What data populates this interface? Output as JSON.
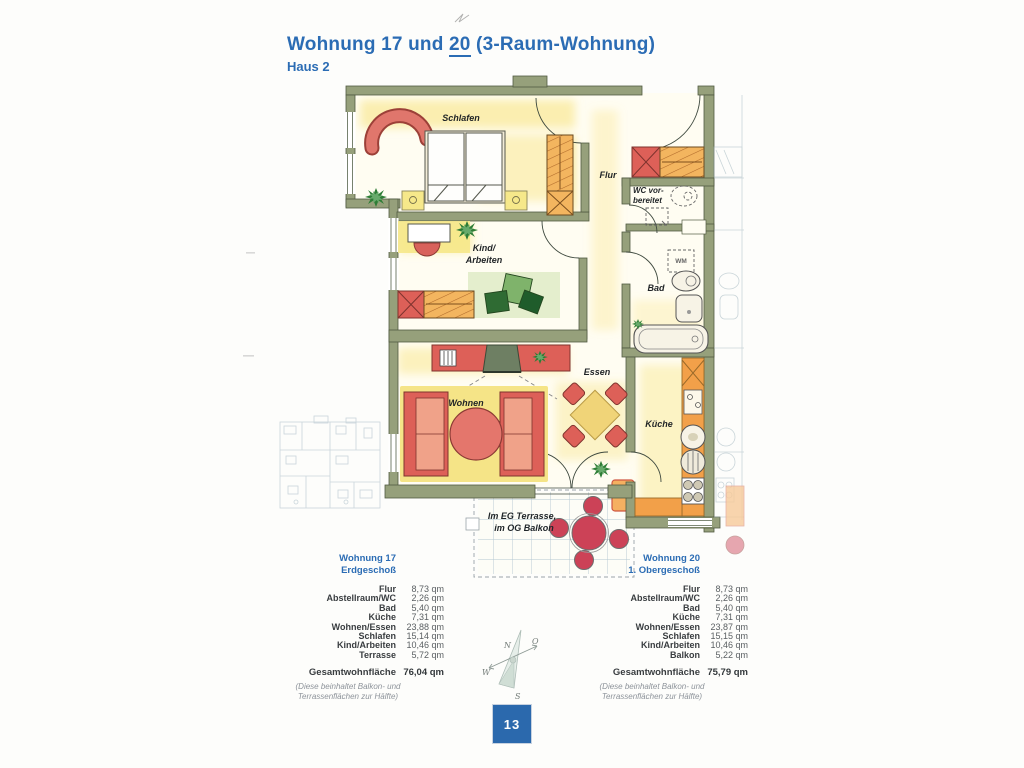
{
  "page": {
    "title_prefix": "Wohnung 17 und ",
    "title_underlined": "20",
    "title_suffix": " (3-Raum-Wohnung)",
    "subtitle": "Haus 2",
    "page_number": "13"
  },
  "colors": {
    "accent_blue": "#2b6cb4",
    "wall_olive": "#96a07b",
    "furniture_red": "#dd6058",
    "furniture_orange": "#f3b55f",
    "page_box_blue": "#2b69ad"
  },
  "floorplan": {
    "labels": {
      "schlafen": "Schlafen",
      "kind_line1": "Kind/",
      "kind_line2": "Arbeiten",
      "flur": "Flur",
      "wc_line1": "WC vor-",
      "wc_line2": "bereitet",
      "bad": "Bad",
      "wm": "WM",
      "essen": "Essen",
      "kueche": "Küche",
      "wohnen": "Wohnen",
      "terrasse_line1": "Im EG Terrasse,",
      "terrasse_line2": "im OG Balkon"
    },
    "compass": {
      "n": "N",
      "o": "O",
      "s": "S",
      "w": "W"
    }
  },
  "tables": [
    {
      "title_line1": "Wohnung 17",
      "title_line2": "Erdgeschoß",
      "rows": [
        {
          "label": "Flur",
          "value": "8,73 qm"
        },
        {
          "label": "Abstellraum/WC",
          "value": "2,26 qm"
        },
        {
          "label": "Bad",
          "value": "5,40 qm"
        },
        {
          "label": "Küche",
          "value": "7,31 qm"
        },
        {
          "label": "Wohnen/Essen",
          "value": "23,88 qm"
        },
        {
          "label": "Schlafen",
          "value": "15,14 qm"
        },
        {
          "label": "Kind/Arbeiten",
          "value": "10,46 qm"
        },
        {
          "label": "Terrasse",
          "value": "5,72 qm"
        }
      ],
      "total_label": "Gesamtwohnfläche",
      "total_value": "76,04 qm",
      "footnote_line1": "(Diese beinhaltet Balkon- und",
      "footnote_line2": "Terrassenflächen zur Hälfte)"
    },
    {
      "title_line1": "Wohnung 20",
      "title_line2": "1. Obergeschoß",
      "rows": [
        {
          "label": "Flur",
          "value": "8,73 qm"
        },
        {
          "label": "Abstellraum/WC",
          "value": "2,26 qm"
        },
        {
          "label": "Bad",
          "value": "5,40 qm"
        },
        {
          "label": "Küche",
          "value": "7,31 qm"
        },
        {
          "label": "Wohnen/Essen",
          "value": "23,87 qm"
        },
        {
          "label": "Schlafen",
          "value": "15,15 qm"
        },
        {
          "label": "Kind/Arbeiten",
          "value": "10,46 qm"
        },
        {
          "label": "Balkon",
          "value": "5,22 qm"
        }
      ],
      "total_label": "Gesamtwohnfläche",
      "total_value": "75,79 qm",
      "footnote_line1": "(Diese beinhaltet Balkon- und",
      "footnote_line2": "Terrassenflächen zur Hälfte)"
    }
  ]
}
